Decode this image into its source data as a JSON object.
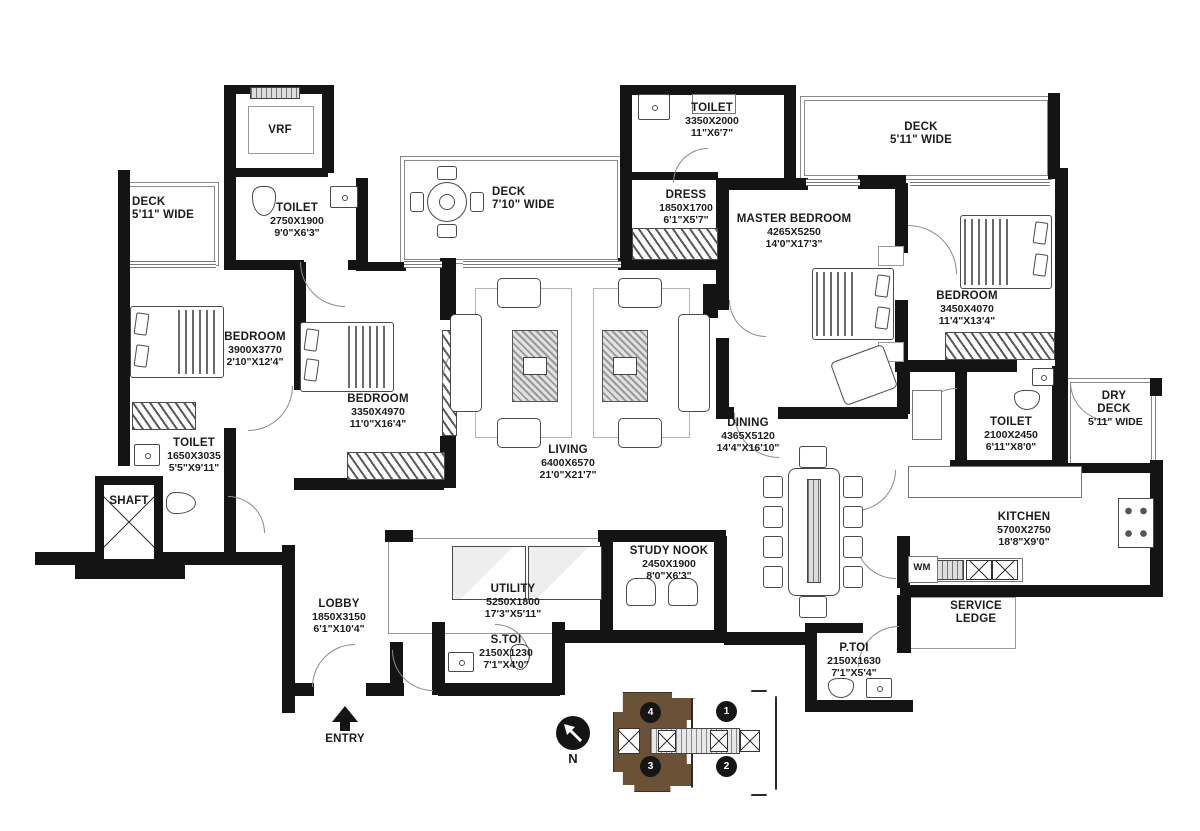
{
  "plan": {
    "rooms": {
      "vrf": {
        "label": "VRF"
      },
      "deck_left": {
        "label": "DECK",
        "size_ft": "5'11\" WIDE"
      },
      "toilet_top_left": {
        "label": "TOILET",
        "size_mm": "2750X1900",
        "size_ft": "9'0\"X6'3\""
      },
      "deck_center": {
        "label": "DECK",
        "size_ft": "7'10\" WIDE"
      },
      "toilet_top": {
        "label": "TOILET",
        "size_mm": "3350X2000",
        "size_ft": "11\"X6'7\""
      },
      "dress": {
        "label": "DRESS",
        "size_mm": "1850X1700",
        "size_ft": "6'1\"X5'7\""
      },
      "master_bedroom": {
        "label": "MASTER BEDROOM",
        "size_mm": "4265X5250",
        "size_ft": "14'0\"X17'3\""
      },
      "deck_right": {
        "label": "DECK",
        "size_ft": "5'11\" WIDE"
      },
      "bedroom_right": {
        "label": "BEDROOM",
        "size_mm": "3450X4070",
        "size_ft": "11'4\"X13'4\""
      },
      "bedroom_left": {
        "label": "BEDROOM",
        "size_mm": "3900X3770",
        "size_ft": "2'10\"X12'4\""
      },
      "bedroom_mid": {
        "label": "BEDROOM",
        "size_mm": "3350X4970",
        "size_ft": "11'0\"X16'4\""
      },
      "living": {
        "label": "LIVING",
        "size_mm": "6400X6570",
        "size_ft": "21'0\"X21'7\""
      },
      "dining": {
        "label": "DINING",
        "size_mm": "4365X5120",
        "size_ft": "14'4\"X16'10\""
      },
      "toilet_bottom_left": {
        "label": "TOILET",
        "size_mm": "1650X3035",
        "size_ft": "5'5\"X9'11\""
      },
      "shaft": {
        "label": "SHAFT"
      },
      "toilet_right": {
        "label": "TOILET",
        "size_mm": "2100X2450",
        "size_ft": "6'11\"X8'0\""
      },
      "dry_deck": {
        "label": "DRY DECK",
        "size_ft": "5'11\" WIDE"
      },
      "kitchen": {
        "label": "KITCHEN",
        "size_mm": "5700X2750",
        "size_ft": "18'8\"X9'0\""
      },
      "study_nook": {
        "label": "STUDY NOOK",
        "size_mm": "2450X1900",
        "size_ft": "8'0\"X6'3\""
      },
      "utility": {
        "label": "UTILITY",
        "size_mm": "5250X1800",
        "size_ft": "17'3\"X5'11\""
      },
      "lobby": {
        "label": "LOBBY",
        "size_mm": "1850X3150",
        "size_ft": "6'1\"X10'4\""
      },
      "s_toi": {
        "label": "S.TOI",
        "size_mm": "2150X1230",
        "size_ft": "7'1\"X4'0\""
      },
      "p_toi": {
        "label": "P.TOI",
        "size_mm": "2150X1630",
        "size_ft": "7'1\"X5'4\""
      },
      "service_ledge": {
        "label": "SERVICE LEDGE"
      },
      "wm": {
        "label": "WM"
      }
    },
    "annotations": {
      "entry": "ENTRY",
      "north": "N"
    },
    "key_plan": {
      "units": [
        "1",
        "2",
        "3",
        "4"
      ],
      "highlight_color": "#6b5236"
    }
  }
}
